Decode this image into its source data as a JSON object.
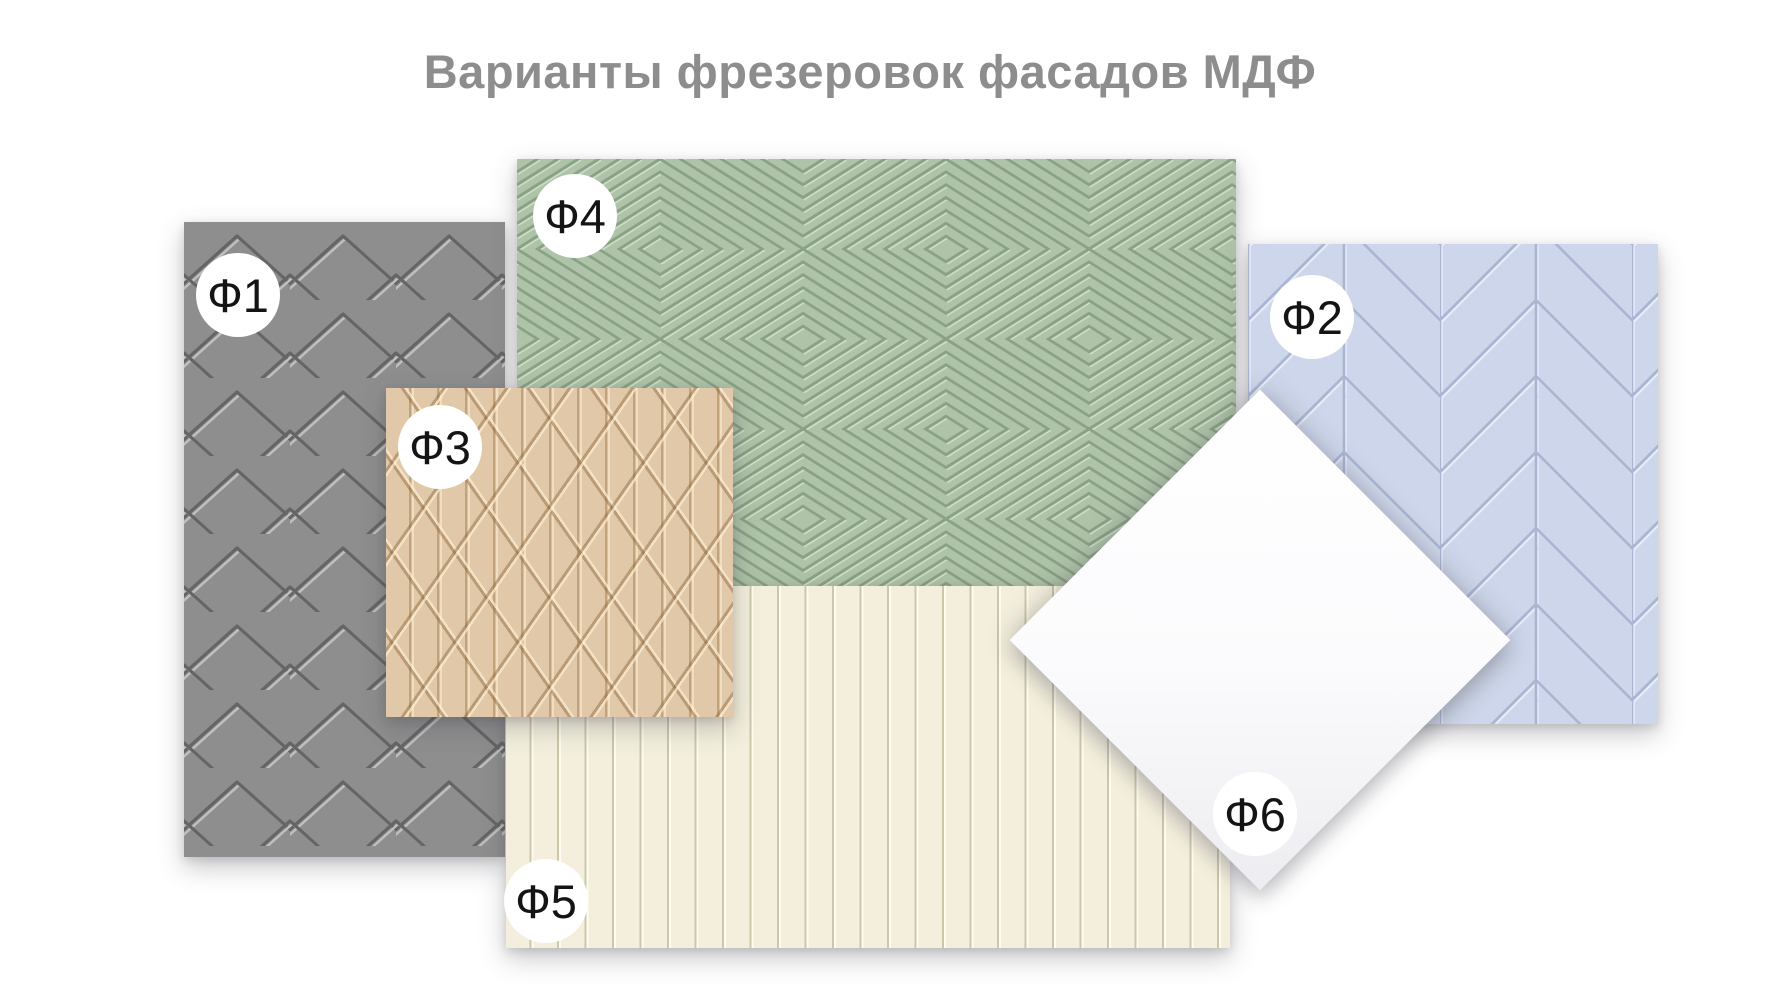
{
  "title": "Варианты фрезеровок фасадов МДФ",
  "title_color": "#8d8d8d",
  "badge_text_color": "#141414",
  "badge_background": "#ffffff",
  "panels": [
    {
      "id": "f1",
      "label": "Ф1",
      "pattern": "chevron-zigzag-grooves",
      "color": "#8e8e8e"
    },
    {
      "id": "f2",
      "label": "Ф2",
      "pattern": "diagonal-chevron-plank",
      "color": "#cdd6ea"
    },
    {
      "id": "f3",
      "label": "Ф3",
      "pattern": "crossing-diagonal-weave",
      "color": "#e0c8a9"
    },
    {
      "id": "f4",
      "label": "Ф4",
      "pattern": "concentric-diamonds",
      "color": "#aec3a8"
    },
    {
      "id": "f5",
      "label": "Ф5",
      "pattern": "vertical-plank-grooves",
      "color": "#f3efdc"
    },
    {
      "id": "f6",
      "label": "Ф6",
      "pattern": "flat-smooth",
      "color": "#ffffff"
    }
  ]
}
